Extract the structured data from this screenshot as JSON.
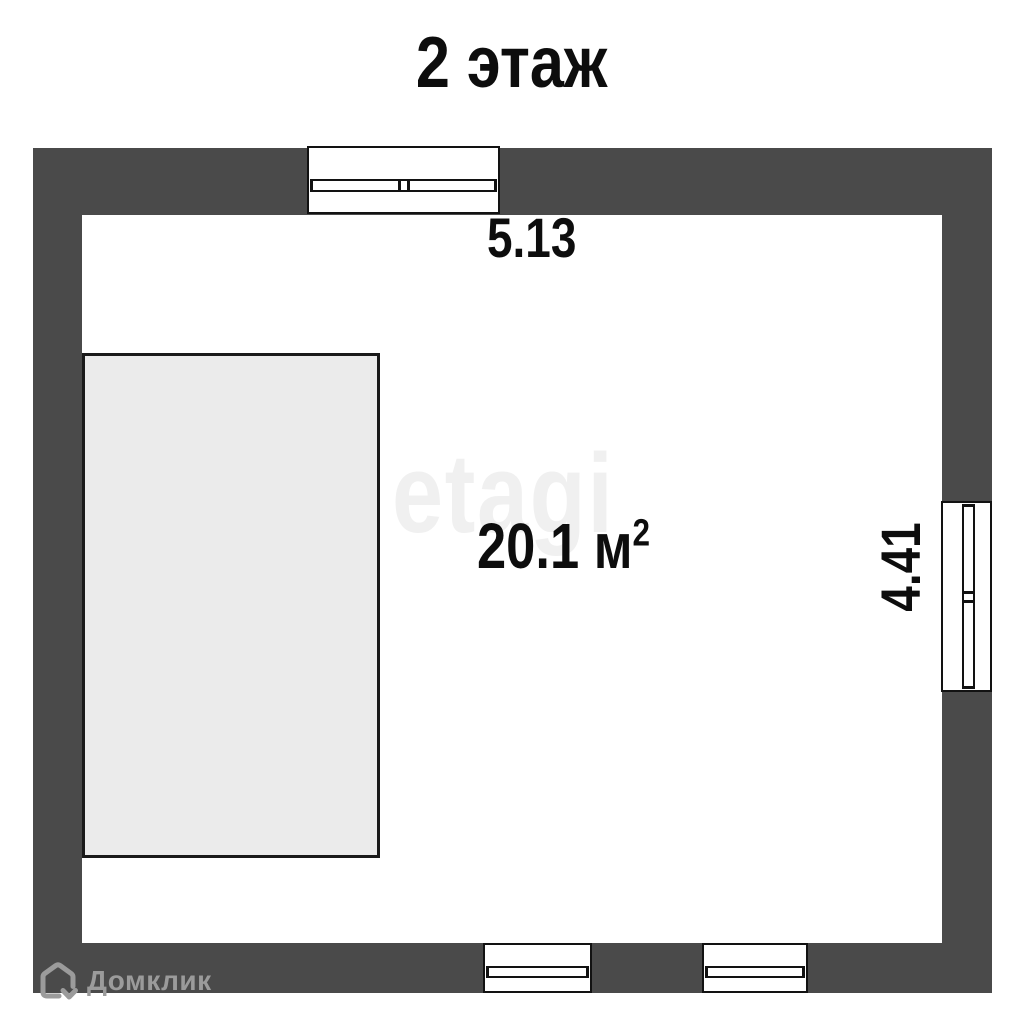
{
  "title": "2 этаж",
  "floor_plan": {
    "room": {
      "area_value": "20.1 м",
      "area_exponent": "2",
      "width_dimension": "5.13",
      "height_dimension": "4.41"
    },
    "windows": {
      "top_wall_count": 1,
      "right_wall_count": 1,
      "bottom_wall_count": 2
    },
    "colors": {
      "wall": "#4a4a4a",
      "interior": "#ffffff",
      "annex_fill": "#ebebeb",
      "outline": "#121212"
    }
  },
  "watermark_text": "etagi",
  "branding": {
    "logo_text": "Домклик",
    "icon": "domclick-house-icon",
    "color": "#9b9b9b"
  }
}
